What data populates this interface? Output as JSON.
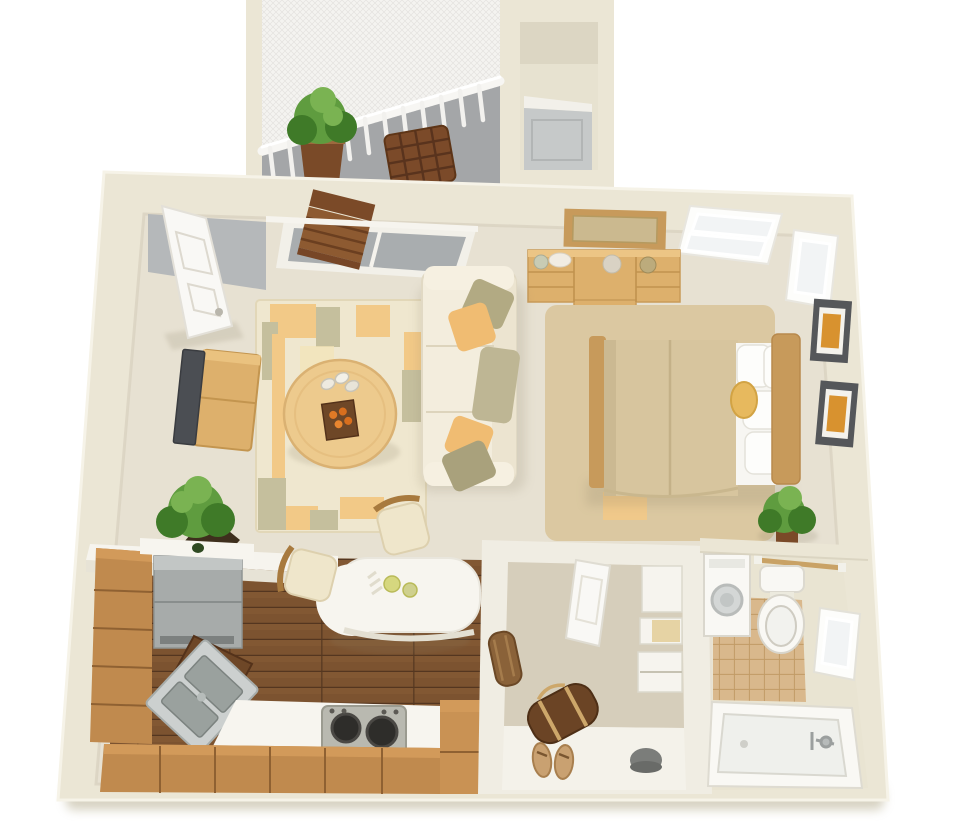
{
  "scene": {
    "type": "3d-floorplan-top-down-render",
    "subject": "studio-apartment",
    "rooms": [
      {
        "id": "balcony",
        "items": [
          "potted-plant",
          "lattice-table",
          "railing",
          "mesh-screen",
          "folding-chair"
        ]
      },
      {
        "id": "entry-niche",
        "items": [
          "entry-door"
        ]
      },
      {
        "id": "living-room",
        "items": [
          "front-door",
          "sliding-glass-door",
          "area-rug",
          "oval-coffee-table",
          "candles",
          "sofa",
          "throw-pillows",
          "tv",
          "tv-console",
          "potted-plant",
          "half-wall"
        ]
      },
      {
        "id": "bedroom",
        "items": [
          "dresser",
          "mirror",
          "queen-bed",
          "white-pillows",
          "round-gold-pillow",
          "headboard",
          "bed-rug",
          "window-top",
          "window-right",
          "wall-art-1",
          "wall-art-2",
          "potted-plant"
        ]
      },
      {
        "id": "kitchen",
        "items": [
          "left-cabinets",
          "refrigerator",
          "corner-sink",
          "dark-corner-counter",
          "counter",
          "stove",
          "bottom-cabinets",
          "right-cabinet",
          "wood-plank-floor",
          "breakfast-bar",
          "bar-chair-1",
          "bar-chair-2",
          "green-bottle",
          "plates"
        ]
      },
      {
        "id": "walk-in-closet",
        "items": [
          "closet-door",
          "shelves",
          "drawer-unit",
          "duffel-bag",
          "bedroll",
          "sandals",
          "beanie"
        ]
      },
      {
        "id": "bathroom",
        "items": [
          "washer",
          "toilet",
          "towel-bar",
          "tile-floor",
          "window",
          "bathtub",
          "faucet"
        ]
      }
    ]
  },
  "colors": {
    "background": "#ffffff",
    "wall": "#ebe6d5",
    "wallShade": "#d8d2be",
    "wallHighlight": "#f6f3e8",
    "carpet": "#e7e1d2",
    "carpetShade": "#d9d2c0",
    "balconyFloor": "#a4a6a8",
    "mesh": "#f4f3f0",
    "railWhite": "#f4f3ef",
    "vestibuleGray": "#b5b8ba",
    "glassGray": "#a9adaf",
    "doorWhite": "#f9f8f5",
    "doorGray": "#c6c9c9",
    "woodLight": "#ddb06c",
    "woodMid": "#c79a5b",
    "woodDark": "#8a5a33",
    "chairWood": "#8d5a31",
    "rugBase": "#efe7cf",
    "rugOrange": "#f2c987",
    "rugOlive": "#c5bf9d",
    "rugYellow": "#f4e4b6",
    "tableWood": "#edca8d",
    "sofaCream": "#f3eddd",
    "sofaShade": "#ece4d0",
    "pillowOlive": "#b2aa83",
    "pillowKhaki": "#beb694",
    "pillowOrange": "#f0bc72",
    "pillowWhite": "#fdfdfb",
    "tvDark": "#4b4e53",
    "bedRug": "#dbc8a1",
    "duvet": "#d7c59e",
    "sheetWhite": "#f7f6f2",
    "goldPillow": "#e7b95e",
    "plantGreen": "#5f9c3f",
    "plantDark": "#3f7a28",
    "plantLight": "#7ab352",
    "planterBrown": "#7a4a28",
    "potDark": "#3e2f1d",
    "frameDark": "#55575a",
    "artOrange": "#d8922f",
    "cabinetWood": "#c08a4e",
    "cabinetWoodLight": "#d29a5a",
    "cabinetLine": "#8f6132",
    "floorWood": "#7c5330",
    "plankLine": "#543620",
    "fridgeGray": "#a7abaa",
    "steel": "#ccd0cf",
    "steelDark": "#9aa19e",
    "stoveGray": "#b9b9b0",
    "burnerDark": "#2e2d2a",
    "counterWhite": "#f7f5ef",
    "darkCounter": "#6e4727",
    "closetWall": "#f0ede3",
    "closetCarpet": "#d6cebb",
    "closetFloorLight": "#f4f2ea",
    "shelfWhite": "#f6f4ee",
    "shelfBack": "#e6d3a4",
    "duffelBrown": "#6b4425",
    "strapTan": "#cda76a",
    "rollBrown": "#8a6239",
    "sandalTan": "#c9a171",
    "beanieGray": "#7b7d7a",
    "tileTan": "#d9b88c",
    "tileLine": "#c19b66",
    "fixtureWhite": "#f9f8f4",
    "fixtureShade": "#d8d5cb",
    "tubInner": "#eff0ec",
    "windowWhite": "#fdfdfb",
    "paneGray": "#f2f4f5",
    "towelRod": "#c9a265",
    "shadow": "#8a8066"
  }
}
